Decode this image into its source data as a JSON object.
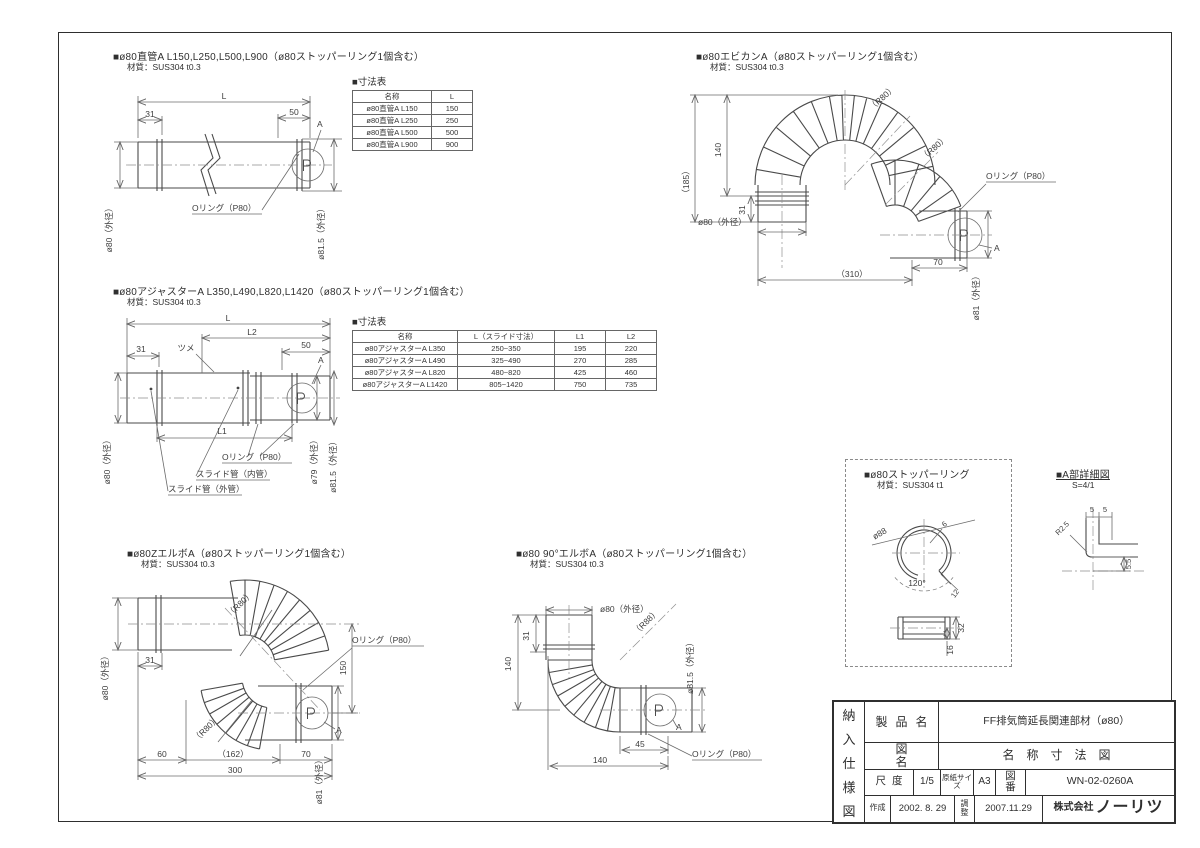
{
  "sections": {
    "straight": {
      "title": "■ø80直管A L150,L250,L500,L900（ø80ストッパーリング1個含む）",
      "material": "材質：SUS304 t0.3",
      "labels": {
        "L": "L",
        "d31": "31",
        "d50": "50",
        "a": "A",
        "oring": "Oリング（P80）",
        "od_left": "ø80（外径）",
        "od_right": "ø81.5（外径）"
      },
      "table": {
        "title": "■寸法表",
        "headers": [
          "名称",
          "L"
        ],
        "rows": [
          [
            "ø80直管A L150",
            "150"
          ],
          [
            "ø80直管A L250",
            "250"
          ],
          [
            "ø80直管A L500",
            "500"
          ],
          [
            "ø80直管A L900",
            "900"
          ]
        ]
      }
    },
    "ebikan": {
      "title": "■ø80エビカンA（ø80ストッパーリング1個含む）",
      "material": "材質：SUS304 t0.3",
      "labels": {
        "r80a": "（R80）",
        "r80b": "（R80）",
        "d185": "（185）",
        "d140": "140",
        "d31": "31",
        "od_left": "ø80（外径）",
        "d310": "（310）",
        "d70": "70",
        "od_right": "ø81（外径）",
        "oring": "Oリング（P80）",
        "a": "A"
      }
    },
    "adjuster": {
      "title": "■ø80アジャスターA L350,L490,L820,L1420（ø80ストッパーリング1個含む）",
      "material": "材質：SUS304 t0.3",
      "labels": {
        "L": "L",
        "L2": "L2",
        "d31": "31",
        "tsume": "ツメ",
        "d50": "50",
        "a": "A",
        "L1": "L1",
        "oring": "Oリング（P80）",
        "slide_in": "スライド管（内管）",
        "slide_out": "スライド管（外管）",
        "od_left": "ø80（外径）",
        "od_mid": "ø79（外径）",
        "od_right": "ø81.5（外径）"
      },
      "table": {
        "title": "■寸法表",
        "headers": [
          "名称",
          "L（スライド寸法）",
          "L1",
          "L2"
        ],
        "rows": [
          [
            "ø80アジャスターA L350",
            "250~350",
            "195",
            "220"
          ],
          [
            "ø80アジャスターA L490",
            "325~490",
            "270",
            "285"
          ],
          [
            "ø80アジャスターA L820",
            "480~820",
            "425",
            "460"
          ],
          [
            "ø80アジャスターA L1420",
            "805~1420",
            "750",
            "735"
          ]
        ]
      }
    },
    "zelbow": {
      "title": "■ø80ZエルボA（ø80ストッパーリング1個含む）",
      "material": "材質：SUS304 t0.3",
      "labels": {
        "r80a": "（R80）",
        "r80b": "（R80）",
        "d31": "31",
        "oring": "Oリング（P80）",
        "d150": "150",
        "od_left": "ø80（外径）",
        "d60": "60",
        "d162": "（162）",
        "d70": "70",
        "d300": "300",
        "od_right": "ø81（外径）",
        "a": "A"
      }
    },
    "elbow90": {
      "title": "■ø80 90°エルボA（ø80ストッパーリング1個含む）",
      "material": "材質：SUS304 t0.3",
      "labels": {
        "od_top": "ø80（外径）",
        "d31": "31",
        "d140l": "140",
        "r88": "（R88）",
        "od_right": "ø81.5（外径）",
        "d45": "45",
        "d140b": "140",
        "oring": "Oリング（P80）",
        "a": "A"
      }
    },
    "stopper": {
      "title": "■ø80ストッパーリング",
      "material": "材質：SUS304 t1",
      "labels": {
        "d88": "ø88",
        "d6": "6",
        "d120": "120°",
        "d12": "12",
        "d32": "32",
        "d16": "16"
      }
    },
    "adetail": {
      "title": "■A部詳細図",
      "scale": "S=4/1",
      "labels": {
        "d5a": "5",
        "d5b": "5",
        "r25": "R2.5",
        "d55": "5.5"
      }
    }
  },
  "titleblock": {
    "side": [
      "納",
      "入",
      "仕",
      "様",
      "図"
    ],
    "product_label": "製品名",
    "product_value": "FF排気筒延長関連部材（ø80）",
    "name_label": "図名",
    "name_value": "名称寸法図",
    "scale_label": "尺度",
    "scale_value": "1/5",
    "paper_label": "原紙サイズ",
    "paper_value": "A3",
    "num_label": "図番",
    "num_value": "WN-02-0260A",
    "made_label": "作成",
    "made_value": "2002. 8. 29",
    "adj_label": "調整",
    "adj_value": "2007.11.29",
    "company_prefix": "株式会社",
    "company_name": "ノーリツ"
  }
}
